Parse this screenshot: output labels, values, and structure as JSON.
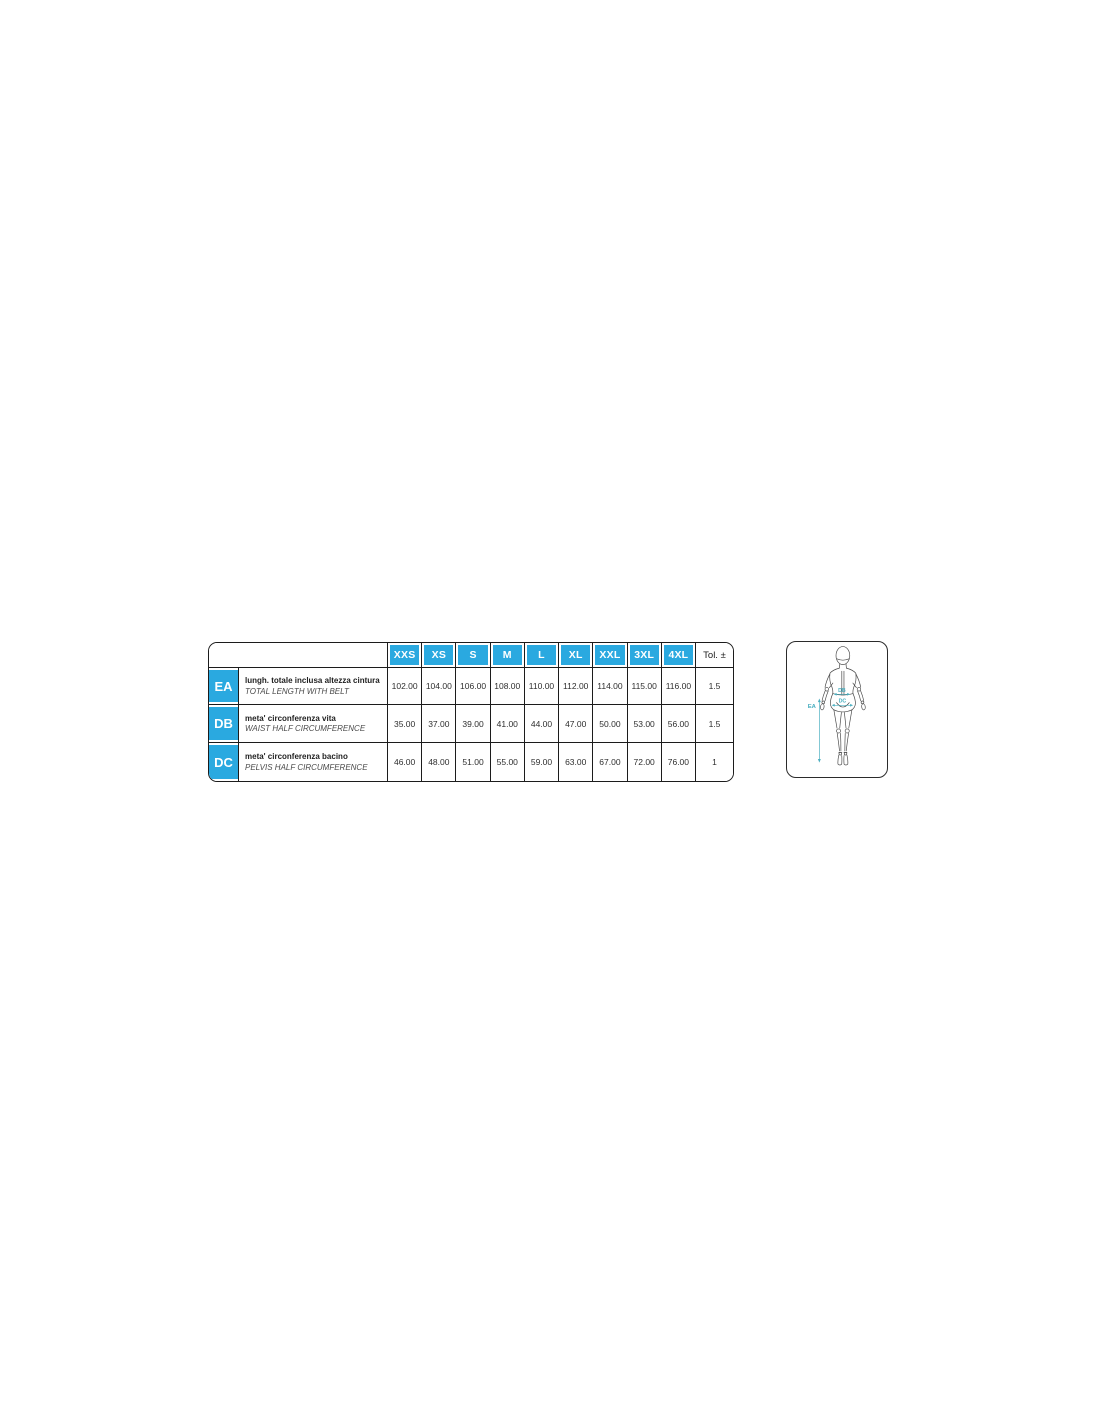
{
  "page": {
    "background_color": "#ffffff"
  },
  "size_chart": {
    "accent_color": "#2aa9e0",
    "grid_color": "#1c1c1c",
    "size_headers": [
      "XXS",
      "XS",
      "S",
      "M",
      "L",
      "XL",
      "XXL",
      "3XL",
      "4XL"
    ],
    "tolerance_header": "Tol. ±",
    "rows": [
      {
        "code": "EA",
        "description_it": "lungh. totale inclusa altezza cintura",
        "description_en": "TOTAL LENGTH WITH BELT",
        "values": [
          "102.00",
          "104.00",
          "106.00",
          "108.00",
          "110.00",
          "112.00",
          "114.00",
          "115.00",
          "116.00"
        ],
        "tolerance": "1.5"
      },
      {
        "code": "DB",
        "description_it": "meta' circonferenza vita",
        "description_en": "WAIST HALF CIRCUMFERENCE",
        "values": [
          "35.00",
          "37.00",
          "39.00",
          "41.00",
          "44.00",
          "47.00",
          "50.00",
          "53.00",
          "56.00"
        ],
        "tolerance": "1.5"
      },
      {
        "code": "DC",
        "description_it": "meta' circonferenza bacino",
        "description_en": "PELVIS HALF CIRCUMFERENCE",
        "values": [
          "46.00",
          "48.00",
          "51.00",
          "55.00",
          "59.00",
          "63.00",
          "67.00",
          "72.00",
          "76.00"
        ],
        "tolerance": "1"
      }
    ]
  },
  "figure": {
    "arrow_color": "#4bafc0",
    "labels": {
      "total_length": "EA",
      "waist": "DB",
      "pelvis": "DC"
    }
  }
}
